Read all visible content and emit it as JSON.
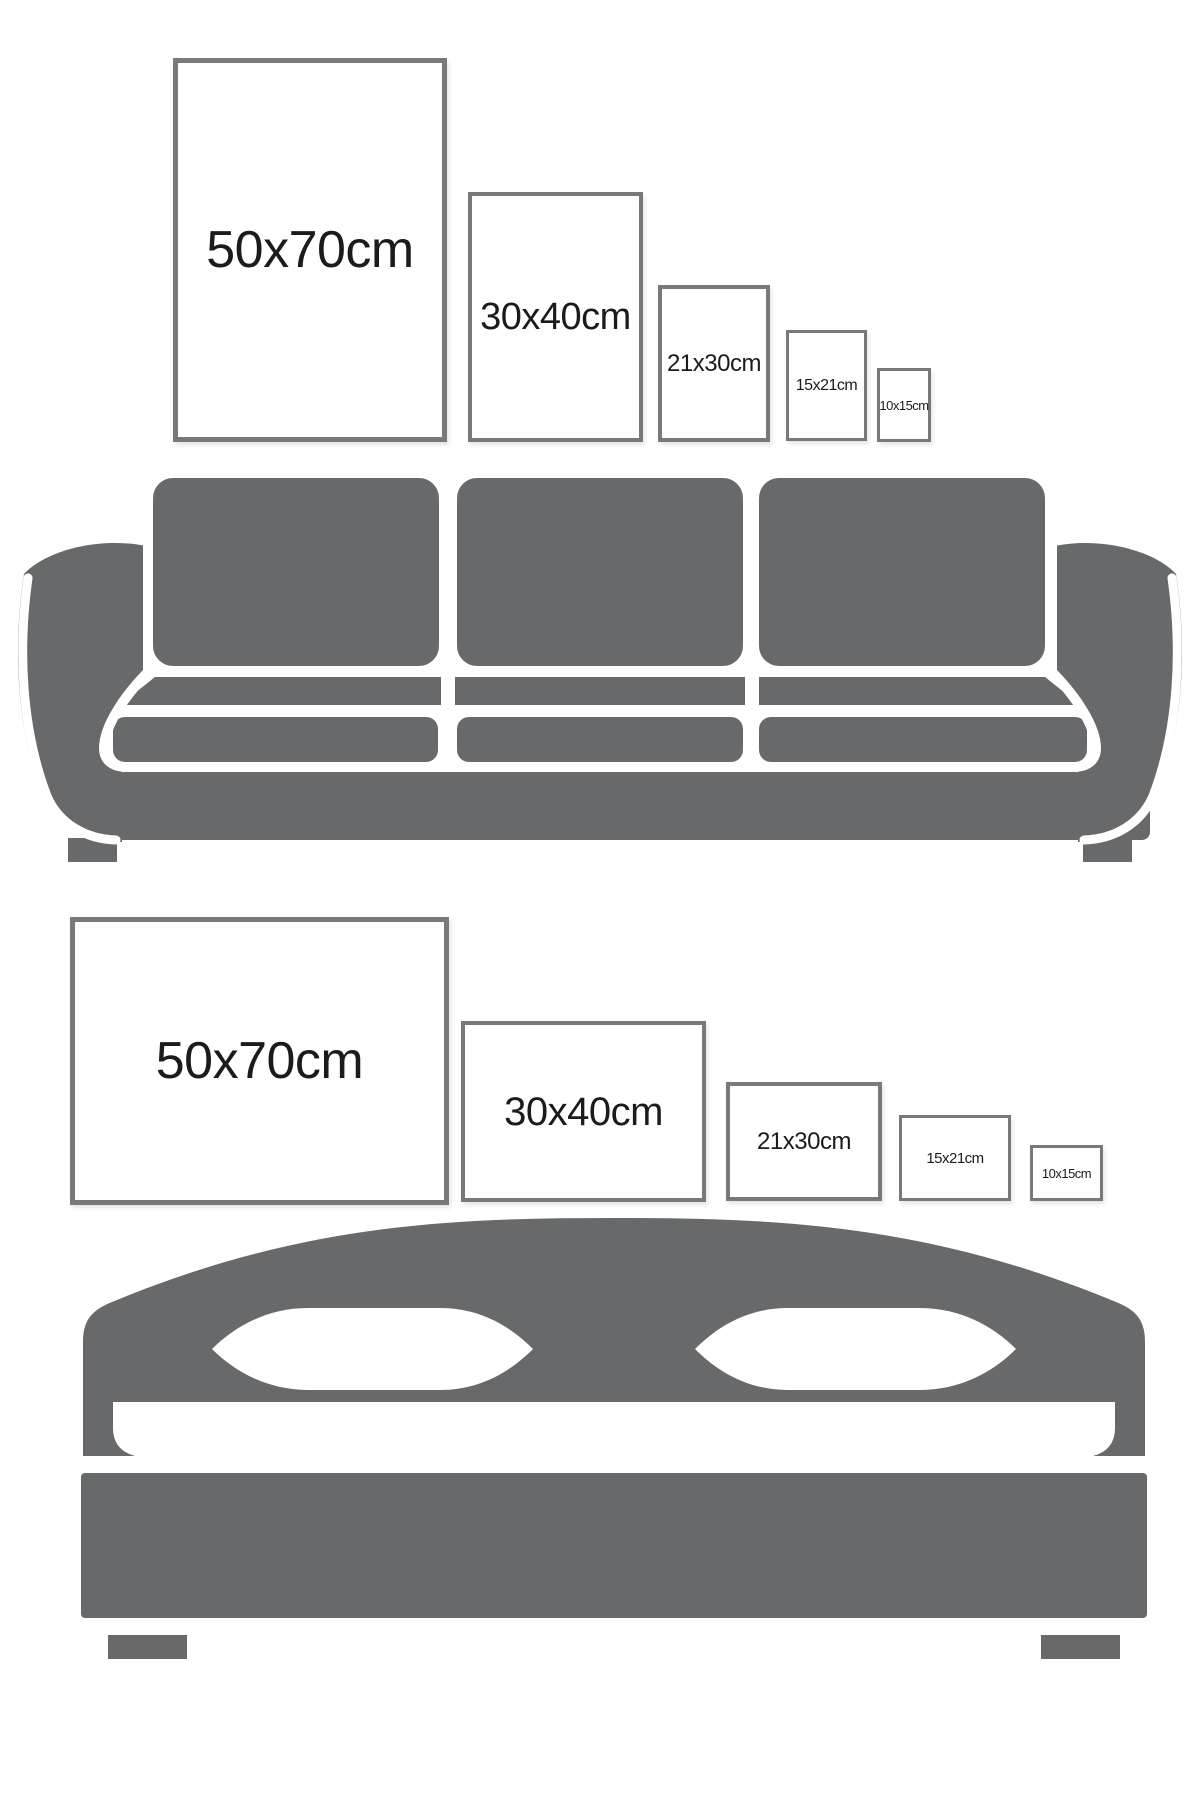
{
  "palette": {
    "background": "#ffffff",
    "furniture_gray": "#67696a",
    "frame_border": "#77797a",
    "frame_fill": "#ffffff",
    "label_text": "#1b1b1b"
  },
  "sofa_section": {
    "illustration": "sofa-icon",
    "frames": [
      {
        "label": "50x70cm",
        "orientation": "portrait"
      },
      {
        "label": "30x40cm",
        "orientation": "portrait"
      },
      {
        "label": "21x30cm",
        "orientation": "portrait"
      },
      {
        "label": "15x21cm",
        "orientation": "portrait"
      },
      {
        "label": "10x15cm",
        "orientation": "portrait"
      }
    ]
  },
  "bed_section": {
    "illustration": "bed-icon",
    "frames": [
      {
        "label": "50x70cm",
        "orientation": "landscape"
      },
      {
        "label": "30x40cm",
        "orientation": "landscape"
      },
      {
        "label": "21x30cm",
        "orientation": "landscape"
      },
      {
        "label": "15x21cm",
        "orientation": "landscape"
      },
      {
        "label": "10x15cm",
        "orientation": "landscape"
      }
    ]
  }
}
